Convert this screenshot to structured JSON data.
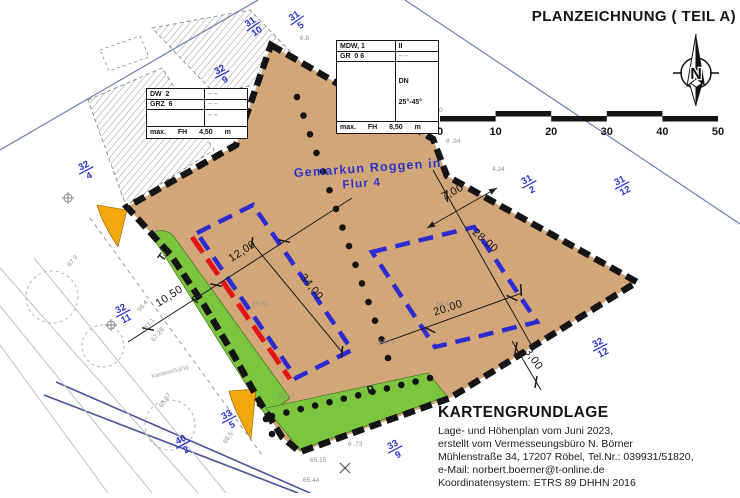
{
  "title": "PLANZEICHNUNG ( TEIL A)",
  "north": {
    "label": "N"
  },
  "scale_bar": {
    "ticks": [
      "0",
      "10",
      "20",
      "30",
      "40",
      "50"
    ]
  },
  "spec_table_right": {
    "r1c1": "MDW, 1",
    "r1c2": "II",
    "r2c1": "GR  0 6",
    "r2c2": "– –",
    "r3c2a": "DN",
    "r3c2b": "25°-45°",
    "footer": "max.  FH  8,50  m"
  },
  "spec_table_left": {
    "r1c1": "DW  2",
    "r1c2": "– –",
    "r2c1": "GRZ  6",
    "r2c2": "– –",
    "r3c2": "– –",
    "footer": "max.  FH  4,50  m"
  },
  "district": {
    "line1": "Gemarkun  Roggen in",
    "line2": "Flur  4"
  },
  "area_labels": [
    {
      "text": "T.",
      "x": 163,
      "y": 262,
      "rot": -55
    },
    {
      "text": "P",
      "x": 197,
      "y": 304,
      "rot": -55
    },
    {
      "text": "P",
      "x": 368,
      "y": 394,
      "rot": -15
    }
  ],
  "parcel_labels": [
    {
      "num": "31",
      "den": "10",
      "x": 253,
      "y": 26,
      "rot": -35
    },
    {
      "num": "31",
      "den": "5",
      "x": 297,
      "y": 20,
      "rot": -35
    },
    {
      "num": "32",
      "den": "9",
      "x": 222,
      "y": 74,
      "rot": -28
    },
    {
      "num": "32",
      "den": "4",
      "x": 86,
      "y": 170,
      "rot": -28
    },
    {
      "num": "32",
      "den": "11",
      "x": 123,
      "y": 313,
      "rot": -28
    },
    {
      "num": "33",
      "den": "5",
      "x": 229,
      "y": 419,
      "rot": -28
    },
    {
      "num": "40",
      "den": "2",
      "x": 183,
      "y": 444,
      "rot": -28
    },
    {
      "num": "33",
      "den": "9",
      "x": 395,
      "y": 449,
      "rot": -28
    },
    {
      "num": "32",
      "den": "12",
      "x": 600,
      "y": 347,
      "rot": -28
    },
    {
      "num": "31",
      "den": "2",
      "x": 529,
      "y": 184,
      "rot": -28
    },
    {
      "num": "31",
      "den": "12",
      "x": 622,
      "y": 185,
      "rot": -28
    }
  ],
  "dimensions": [
    {
      "label": "10,50",
      "x": 171,
      "y": 299,
      "rot": -33,
      "line": [
        128,
        342,
        352,
        198
      ],
      "ticks": [
        [
          148,
          329
        ],
        [
          216,
          285
        ],
        [
          284,
          241
        ]
      ]
    },
    {
      "label": "12,00",
      "x": 244,
      "y": 254,
      "rot": -33
    },
    {
      "label": "34,00",
      "x": 309,
      "y": 289,
      "rot": 51,
      "line": [
        252,
        243,
        342,
        352
      ],
      "ticks": [
        [
          252,
          243
        ],
        [
          342,
          352
        ]
      ]
    },
    {
      "label": "7,00",
      "x": 454,
      "y": 195,
      "rot": -28,
      "line": [
        427,
        228,
        497,
        188
      ],
      "arrows": true
    },
    {
      "label": "28,00",
      "x": 483,
      "y": 243,
      "rot": 41,
      "line": [
        433,
        170,
        534,
        350
      ],
      "ticks": [
        [
          447,
          196
        ],
        [
          521,
          290
        ]
      ]
    },
    {
      "label": "20,00",
      "x": 449,
      "y": 311,
      "rot": -18,
      "line": [
        380,
        344,
        522,
        293
      ],
      "ticks": [
        [
          430,
          330
        ],
        [
          512,
          298
        ]
      ]
    },
    {
      "label": "3,00",
      "x": 531,
      "y": 361,
      "rot": 55,
      "line": [
        512,
        341,
        541,
        390
      ],
      "ticks": [
        [
          516,
          348
        ],
        [
          536,
          382
        ]
      ]
    }
  ],
  "elevations": [
    {
      "text": "6.8",
      "x": 300,
      "y": 40,
      "rot": 0
    },
    {
      "text": "5.35",
      "x": 392,
      "y": 88,
      "rot": 0
    },
    {
      "text": "5.54",
      "x": 358,
      "y": 112,
      "rot": 0
    },
    {
      "text": "4.20",
      "x": 430,
      "y": 112,
      "rot": 0
    },
    {
      "text": "8 .94",
      "x": 446,
      "y": 143,
      "rot": 0
    },
    {
      "text": "4.24",
      "x": 492,
      "y": 171,
      "rot": 0
    },
    {
      "text": "65.70",
      "x": 252,
      "y": 306,
      "rot": 0
    },
    {
      "text": "64.46",
      "x": 436,
      "y": 306,
      "rot": 0
    },
    {
      "text": "64.74",
      "x": 378,
      "y": 344,
      "rot": 0
    },
    {
      "text": "65.67",
      "x": 278,
      "y": 398,
      "rot": 0
    },
    {
      "text": "65.15",
      "x": 310,
      "y": 462,
      "rot": 0
    },
    {
      "text": "65.44",
      "x": 303,
      "y": 482,
      "rot": 0
    },
    {
      "text": "8 .73",
      "x": 348,
      "y": 446,
      "rot": 0
    },
    {
      "text": "66.4",
      "x": 140,
      "y": 312,
      "rot": -50
    },
    {
      "text": "67.1",
      "x": 147,
      "y": 330,
      "rot": -50
    },
    {
      "text": "67.26",
      "x": 154,
      "y": 342,
      "rot": -50
    },
    {
      "text": "67.9",
      "x": 70,
      "y": 267,
      "rot": -50
    },
    {
      "text": "65.67",
      "x": 162,
      "y": 408,
      "rot": -55
    },
    {
      "text": "66.5",
      "x": 226,
      "y": 444,
      "rot": -55
    }
  ],
  "tree_note": {
    "text": "Kastanie/0,6/16",
    "x": 152,
    "y": 378,
    "rot": -14
  },
  "kartengrundlage": {
    "heading": "KARTENGRUNDLAGE",
    "lines": [
      "Lage- und Höhenplan vom Juni 2023,",
      "erstellt vom Vermesseungsbüro N. Börner",
      "Mühlenstraße 34, 17207 Röbel, Tel.Nr.: 039931/51820,",
      "e-Mail: norbert.boerner@t-online.de",
      "Koordinatensystem: ETRS 89 DHHN 2016"
    ]
  },
  "colors": {
    "parcel_fill": "#d3a679",
    "green": "#7cc63f",
    "yellow": "#f2a70b",
    "envelope_blue": "#2b2bd0",
    "baseline_red": "#e41515",
    "label_blue": "#2a35c8"
  }
}
